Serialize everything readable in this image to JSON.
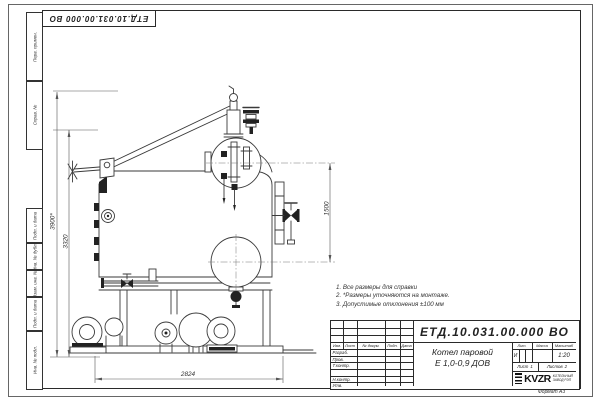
{
  "sheet": {
    "doc_number": "ЕТД.10.031.00.000 ВО",
    "format_label": "Формат А3"
  },
  "notes": [
    "1. Все размеры для справки",
    "2. *Размеры уточняются на монтаже.",
    "3. Допустимые отклонения ±100 мм"
  ],
  "dimensions": {
    "overall_height": "3900*",
    "boiler_height": "3320",
    "drum_to_manhole": "1500",
    "base_length": "2824"
  },
  "margin_labels": [
    "Перв. примен.",
    "Справ. №",
    "Подп. и дата",
    "Инв. № дубл.",
    "Взам. инв. №",
    "Подп. и дата",
    "Инв. № подл."
  ],
  "title_block": {
    "product_name_line1": "Котел паровой",
    "product_name_line2": "Е 1,0-0,9 ДОВ",
    "col_izm": "Изм.",
    "col_list": "Лист",
    "col_docnum": "№ докум.",
    "col_podp": "Подп.",
    "col_data": "Дата",
    "row_razrab": "Разраб.",
    "row_prov": "Пров.",
    "row_tkontr": "Т.контр.",
    "row_nkontr": "Н.контр.",
    "row_utv": "Утв.",
    "lit_label": "Лит.",
    "mass_label": "Масса",
    "scale_label": "Масштаб",
    "lit_value": "И",
    "mass_value": "",
    "scale_value": "1:20",
    "sheet_label": "Лист",
    "sheet_value": "1",
    "sheets_label": "Листов",
    "sheets_value": "2",
    "logo_text": "KVZR",
    "company_line1": "КОТЕЛЬНЫЙ",
    "company_line2": "ЗАВОД РЭП"
  }
}
